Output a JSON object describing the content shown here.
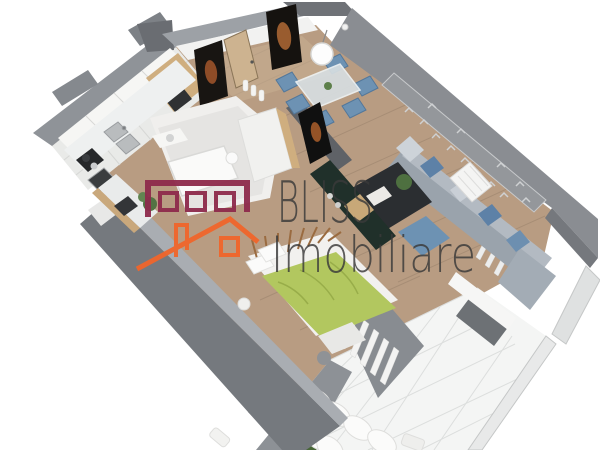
{
  "watermark": {
    "brand_line1": "BLISS",
    "brand_line2": "Imobiliare",
    "text_color": "#3a3a3a",
    "logo": {
      "building_color": "#8e2b4c",
      "house_color": "#f0662b"
    }
  },
  "palette": {
    "background": "#ffffff",
    "wall_gray": "#8a8d92",
    "wall_dark": "#75787d",
    "wall_light_cap": "#9da1a6",
    "floor_wood": "#b89c82",
    "kitchen_cabinet_white": "#f6f6f4",
    "cabinet_wood": "#cfae7f",
    "sofa_gray": "#9aa3ac",
    "accent_blue": "#6d92b3",
    "bed_green": "#b2c75f",
    "terrace_tile": "#f4f5f4",
    "plant_green": "#577a45",
    "portrait_dark": "#181512"
  }
}
